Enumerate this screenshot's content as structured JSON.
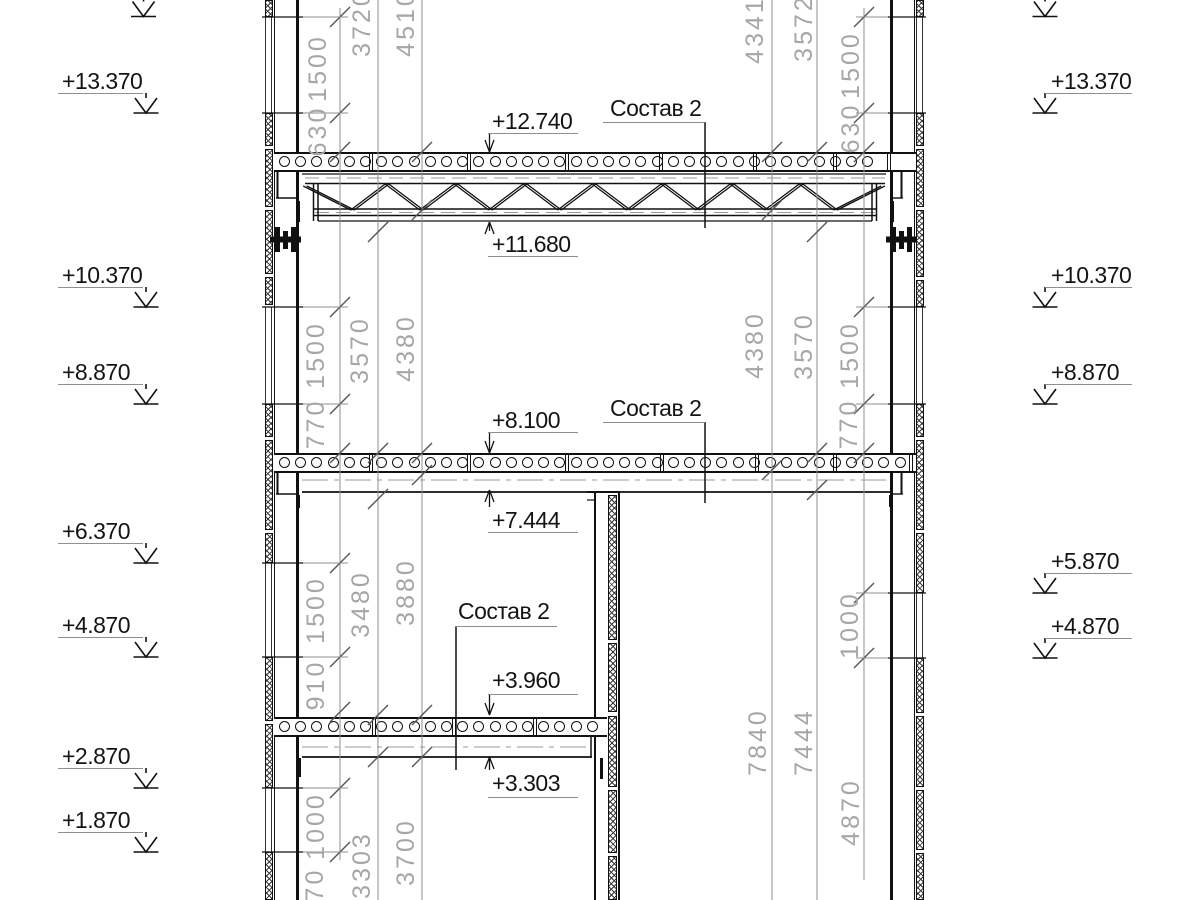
{
  "drawing": {
    "type_note": "building cross-section, reinforced concrete walls with hollow-core floor slabs and a steel truss",
    "composition_callouts": [
      {
        "label": "Состав 2"
      },
      {
        "label": "Состав 2"
      },
      {
        "label": "Состав 2"
      }
    ],
    "elevation_marks_left": [
      "+13.370",
      "+10.370",
      "+8.870",
      "+6.370",
      "+4.870",
      "+2.870",
      "+1.870"
    ],
    "elevation_marks_right": [
      "+13.370",
      "+10.370",
      "+8.870",
      "+5.870",
      "+4.870"
    ],
    "level_callouts": [
      "+12.740",
      "+11.680",
      "+8.100",
      "+7.444",
      "+3.960",
      "+3.303"
    ],
    "dimensions_left": [
      "1500",
      "630",
      "3720",
      "4510",
      "1500",
      "770",
      "3570",
      "4380",
      "1500",
      "910",
      "3480",
      "3880",
      "1000",
      "970",
      "3303",
      "3700"
    ],
    "dimensions_right": [
      "1500",
      "630",
      "3572",
      "4341",
      "1500",
      "770",
      "3570",
      "4380",
      "1000",
      "4870",
      "7444",
      "7840"
    ],
    "colors": {
      "line": "#111111",
      "dim_text": "#a6a6a6",
      "dim_line": "#8f8f8f"
    }
  }
}
